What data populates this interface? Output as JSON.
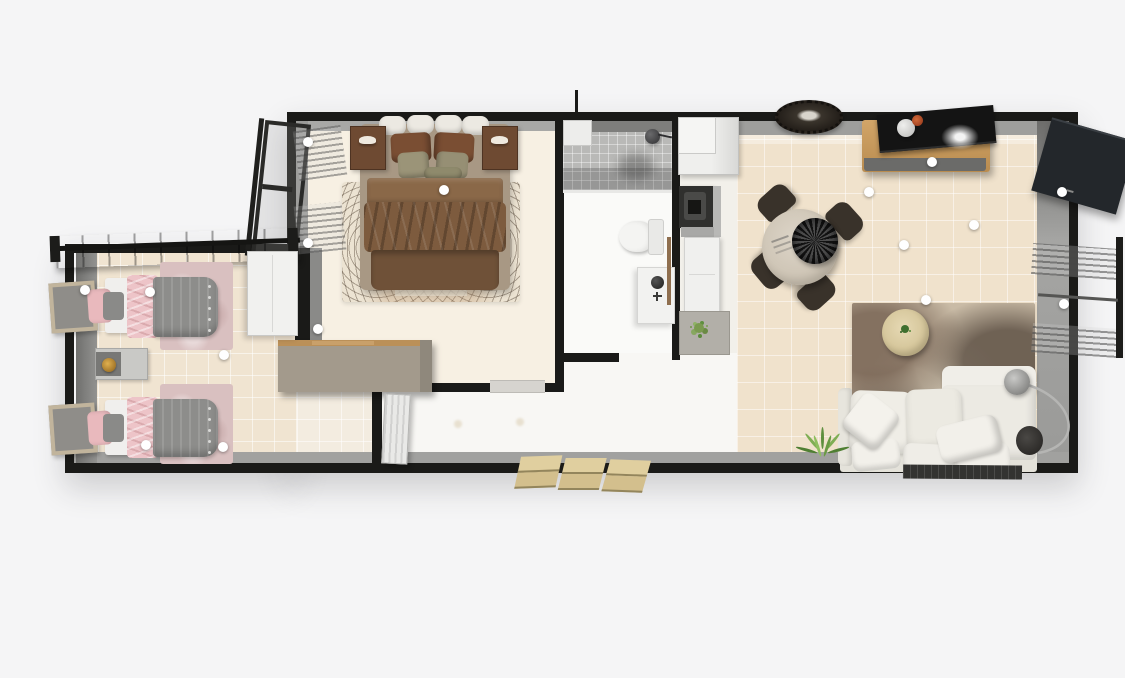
{
  "scene": {
    "type": "3d-floor-plan-top-view",
    "background_color": "#f5f5f6",
    "wall_color": "#1a1a18",
    "wall_inner_face_color": "#a1a19f",
    "marker_color": "#ffffff",
    "marker_count": 16
  },
  "rooms": [
    {
      "id": "kids-bedroom",
      "label": "twin bedroom",
      "floor_color": "#f0e4d1",
      "furniture": [
        "single-bed-1",
        "single-bed-2",
        "bedside-table",
        "gold-table-lamp",
        "pink-area-rug-1",
        "pink-area-rug-2",
        "wardrobe",
        "window-shutter-1",
        "window-shutter-2",
        "window-awning"
      ]
    },
    {
      "id": "master-bedroom",
      "label": "master bedroom",
      "floor_color": "#f7f0e3",
      "furniture": [
        "double-bed",
        "nightstand-left",
        "nightstand-right",
        "patterned-rug",
        "casement-window",
        "dresser"
      ]
    },
    {
      "id": "bathroom",
      "label": "bathroom",
      "floor_color": "#fafaf8",
      "furniture": [
        "shower",
        "shower-head",
        "toilet",
        "sink-vanity"
      ]
    },
    {
      "id": "kitchen",
      "label": "kitchenette",
      "floor_color": "#f2f0ea",
      "furniture": [
        "fridge-cabinet",
        "cooktop",
        "counter",
        "potted-plant-mat"
      ]
    },
    {
      "id": "living-room",
      "label": "living room",
      "floor_color": "#f0e2cc",
      "furniture": [
        "tv-sideboard",
        "tv",
        "flower-vase",
        "white-coral-decor",
        "fringed-wall-decor",
        "round-dining-table",
        "dark-centerpiece-bowl",
        "dining-chairs-x4",
        "abstract-rug",
        "round-coffee-table",
        "sofa-with-chaise",
        "throw-pillows",
        "arc-floor-lamp",
        "floor-plant",
        "doormat",
        "open-door-panel",
        "curtained-window"
      ]
    },
    {
      "id": "hallway",
      "label": "entry hallway",
      "floor_color": "#f8f7f4",
      "furniture": [
        "interior-slatted-door",
        "bedroom-door-threshold",
        "entry-steps"
      ]
    }
  ],
  "entry_steps": {
    "count": 3
  },
  "markers": {
    "description": "white round drag handles on doors, windows and furniture",
    "positions": [
      [
        308,
        142
      ],
      [
        308,
        243
      ],
      [
        444,
        190
      ],
      [
        318,
        329
      ],
      [
        85,
        290
      ],
      [
        150,
        292
      ],
      [
        224,
        355
      ],
      [
        146,
        445
      ],
      [
        223,
        447
      ],
      [
        869,
        192
      ],
      [
        932,
        162
      ],
      [
        904,
        245
      ],
      [
        926,
        300
      ],
      [
        974,
        225
      ],
      [
        1062,
        192
      ],
      [
        1064,
        304
      ]
    ]
  },
  "palette": {
    "exterior_bg": "#f5f5f6",
    "wall_black": "#1a1a18",
    "wall_gray_face": "#a1a19f",
    "twin_floor": "#f0e4d1",
    "bedroom_floor": "#f7f0e3",
    "living_floor": "#f0e2cc",
    "bath_floor": "#fafaf8",
    "shower_tile": "#b9b9b7",
    "duvet_brown": "#7d5b3e",
    "pillow_brown": "#7a4e33",
    "pillow_sage": "#9b9478",
    "nightstand_wood": "#6e4a32",
    "rug_cream": "#ece3d2",
    "twin_duvet_gray": "#8d8d8b",
    "twin_pink": "#e9b9bd",
    "twin_rug_mauve": "#d9c0c0",
    "gold_lamp": "#b8882e",
    "dresser_taupe": "#a39a8c",
    "console_wood": "#c99c60",
    "tv_black": "#141414",
    "chair_brown": "#39322a",
    "table_top": "#d6cdbf",
    "sofa_white": "#eceae3",
    "coffee_table": "#ddcfa8",
    "plant_green": "#5f8f3f",
    "step_tan": "#d3bf8d",
    "door_panel_dark": "#23272b"
  }
}
